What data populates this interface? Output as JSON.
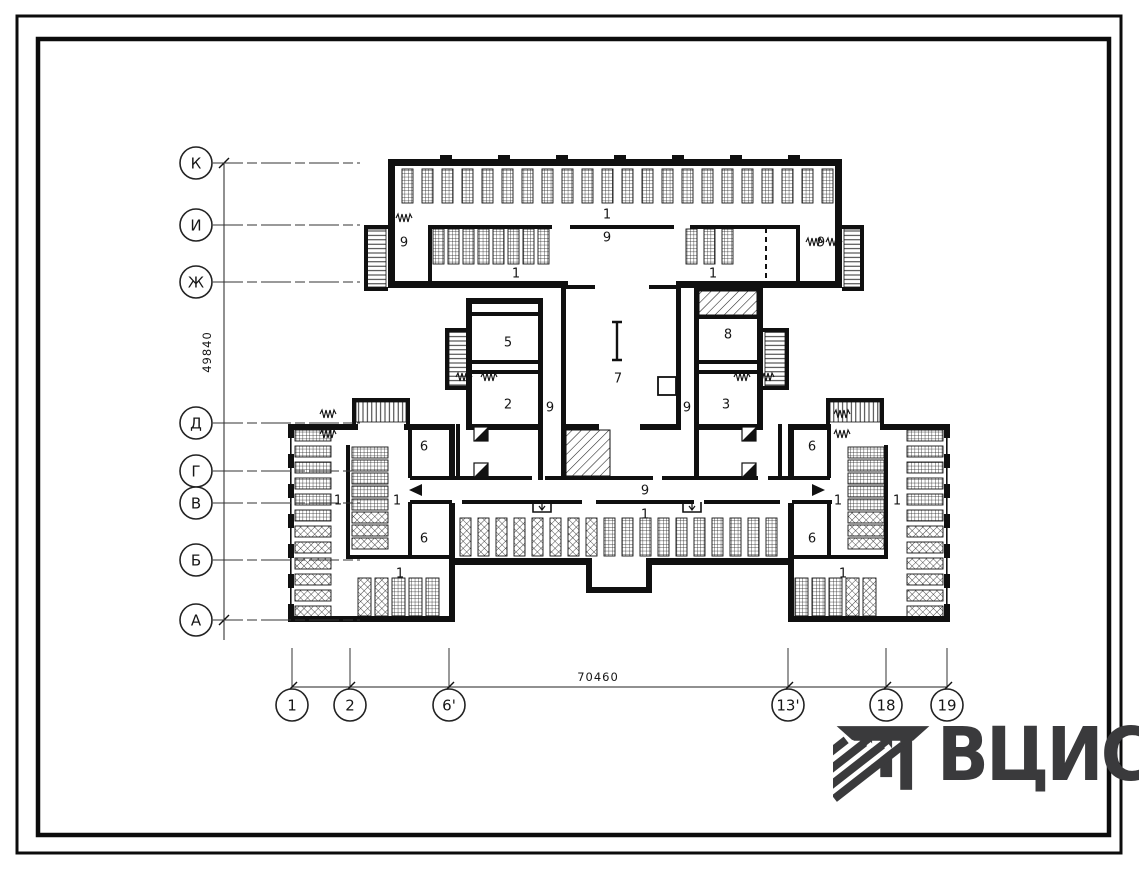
{
  "sheet": {
    "logo_text": "ВЦИС"
  },
  "axes": {
    "vertical": {
      "dimension": "49840",
      "markers": [
        {
          "label": "К",
          "y": 163
        },
        {
          "label": "И",
          "y": 225
        },
        {
          "label": "Ж",
          "y": 282
        },
        {
          "label": "Д",
          "y": 423
        },
        {
          "label": "Г",
          "y": 471
        },
        {
          "label": "В",
          "y": 503
        },
        {
          "label": "Б",
          "y": 560
        },
        {
          "label": "А",
          "y": 620
        }
      ]
    },
    "horizontal": {
      "dimension": "70460",
      "markers": [
        {
          "label": "1",
          "x": 292
        },
        {
          "label": "2",
          "x": 350
        },
        {
          "label": "6'",
          "x": 449
        },
        {
          "label": "13'",
          "x": 788
        },
        {
          "label": "18",
          "x": 886
        },
        {
          "label": "19",
          "x": 947
        }
      ]
    }
  },
  "room_labels": [
    {
      "label": "1",
      "x": 607,
      "y": 214
    },
    {
      "label": "9",
      "x": 607,
      "y": 237
    },
    {
      "label": "9",
      "x": 404,
      "y": 242
    },
    {
      "label": "9",
      "x": 821,
      "y": 242
    },
    {
      "label": "1",
      "x": 516,
      "y": 273
    },
    {
      "label": "1",
      "x": 713,
      "y": 273
    },
    {
      "label": "5",
      "x": 508,
      "y": 342
    },
    {
      "label": "2",
      "x": 508,
      "y": 404
    },
    {
      "label": "9",
      "x": 550,
      "y": 407
    },
    {
      "label": "7",
      "x": 618,
      "y": 378
    },
    {
      "label": "8",
      "x": 728,
      "y": 334
    },
    {
      "label": "3",
      "x": 726,
      "y": 404
    },
    {
      "label": "9",
      "x": 687,
      "y": 407
    },
    {
      "label": "6",
      "x": 424,
      "y": 446
    },
    {
      "label": "6",
      "x": 424,
      "y": 538
    },
    {
      "label": "6",
      "x": 812,
      "y": 446
    },
    {
      "label": "6",
      "x": 812,
      "y": 538
    },
    {
      "label": "1",
      "x": 338,
      "y": 500
    },
    {
      "label": "1",
      "x": 397,
      "y": 500
    },
    {
      "label": "1",
      "x": 838,
      "y": 500
    },
    {
      "label": "1",
      "x": 897,
      "y": 500
    },
    {
      "label": "9",
      "x": 645,
      "y": 490
    },
    {
      "label": "1",
      "x": 645,
      "y": 514
    },
    {
      "label": "1",
      "x": 400,
      "y": 573
    },
    {
      "label": "1",
      "x": 843,
      "y": 573
    }
  ]
}
